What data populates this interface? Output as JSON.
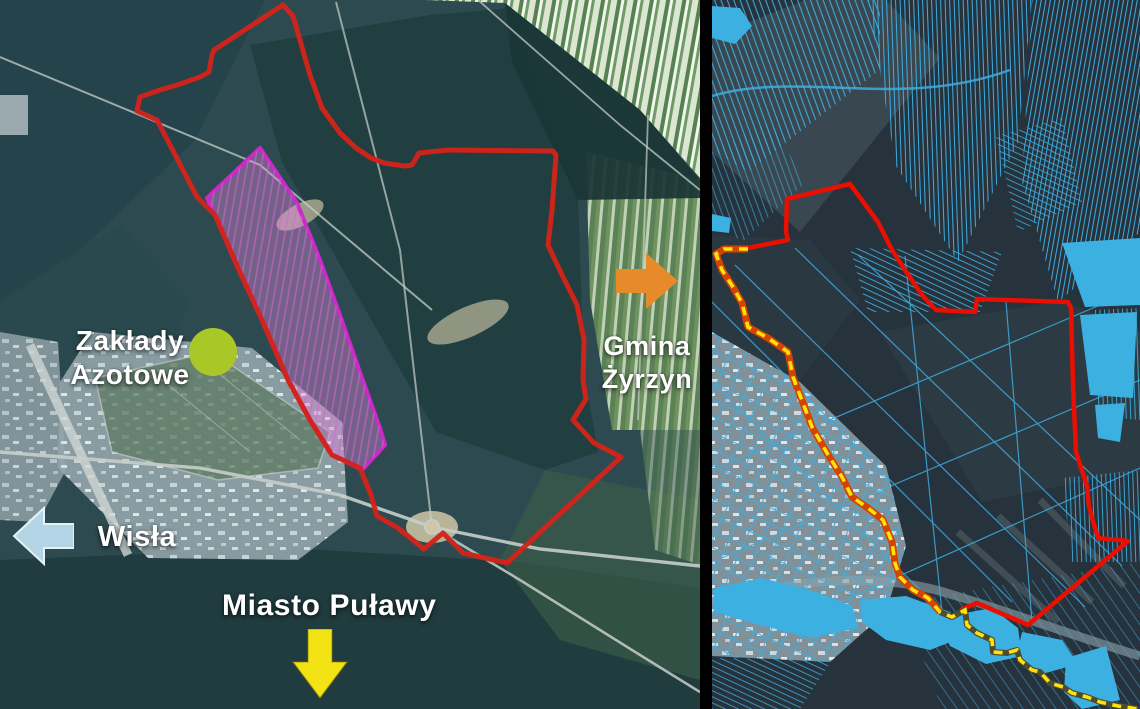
{
  "left_map": {
    "labels": {
      "zaklady": {
        "line1": "Zakłady",
        "line2": "Azotowe"
      },
      "gmina": {
        "line1": "Gmina",
        "line2": "Żyrzyn"
      },
      "wisla": {
        "text": "Wisła"
      },
      "miasto": {
        "text": "Miasto Puławy"
      }
    },
    "arrows": {
      "gmina": {
        "direction": "right"
      },
      "wisla": {
        "direction": "left"
      },
      "miasto": {
        "direction": "down"
      }
    }
  },
  "right_map": {
    "overlays": {
      "parcels": "cadastral-parcel-lines",
      "boundary": "red-boundary-line",
      "pipeline": "yellow-dashed-line",
      "water": "blue-water-fills"
    }
  },
  "colors": {
    "boundary_red_left": "#d2231a",
    "boundary_red_right": "#ea0f00",
    "zone_magenta": "#c92bc7",
    "zone_magenta_fill": "rgba(233,137,227,0.38)",
    "marker_green": "#a9c827",
    "arrow_orange": "#e78a29",
    "arrow_blue": "#b3d4e4",
    "arrow_yellow": "#f2e414",
    "parcel_blue": "#3facde",
    "water_blue": "#3cb0e0",
    "pipeline_yellow": "#ffe20c",
    "pipeline_casing_orange": "#d44300",
    "divider": "#000000"
  }
}
